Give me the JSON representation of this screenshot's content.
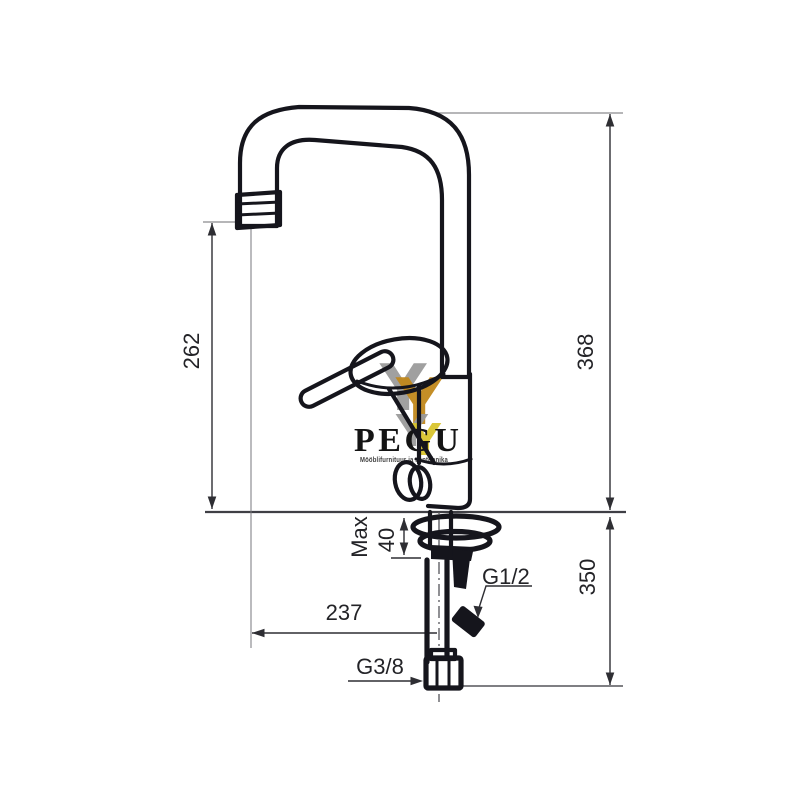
{
  "artwork": {
    "type": "technical dimension drawing",
    "subject": "single-lever high-arc kitchen mixer tap, side elevation"
  },
  "watermark": {
    "brand": "PEGU",
    "tagline": "Mööblifurnituur ja santehnika",
    "logo_glyph": "Y",
    "colors": {
      "gray": "#9b9b9b",
      "gold": "#c1881c",
      "yellow": "#d9c52e",
      "text": "#141414"
    }
  },
  "dimensions": {
    "spout_outlet_height": "262",
    "total_height": "368",
    "below_deck_depth": "350",
    "max_label": "Max",
    "deck_thickness": "40",
    "spout_reach": "237",
    "side_thread": "G1/2",
    "supply_thread": "G3/8"
  },
  "colors": {
    "background": "#ffffff",
    "faucet_line": "#15151c",
    "dimension_line": "#2e2e33",
    "extension_line": "#8a8a8e"
  }
}
